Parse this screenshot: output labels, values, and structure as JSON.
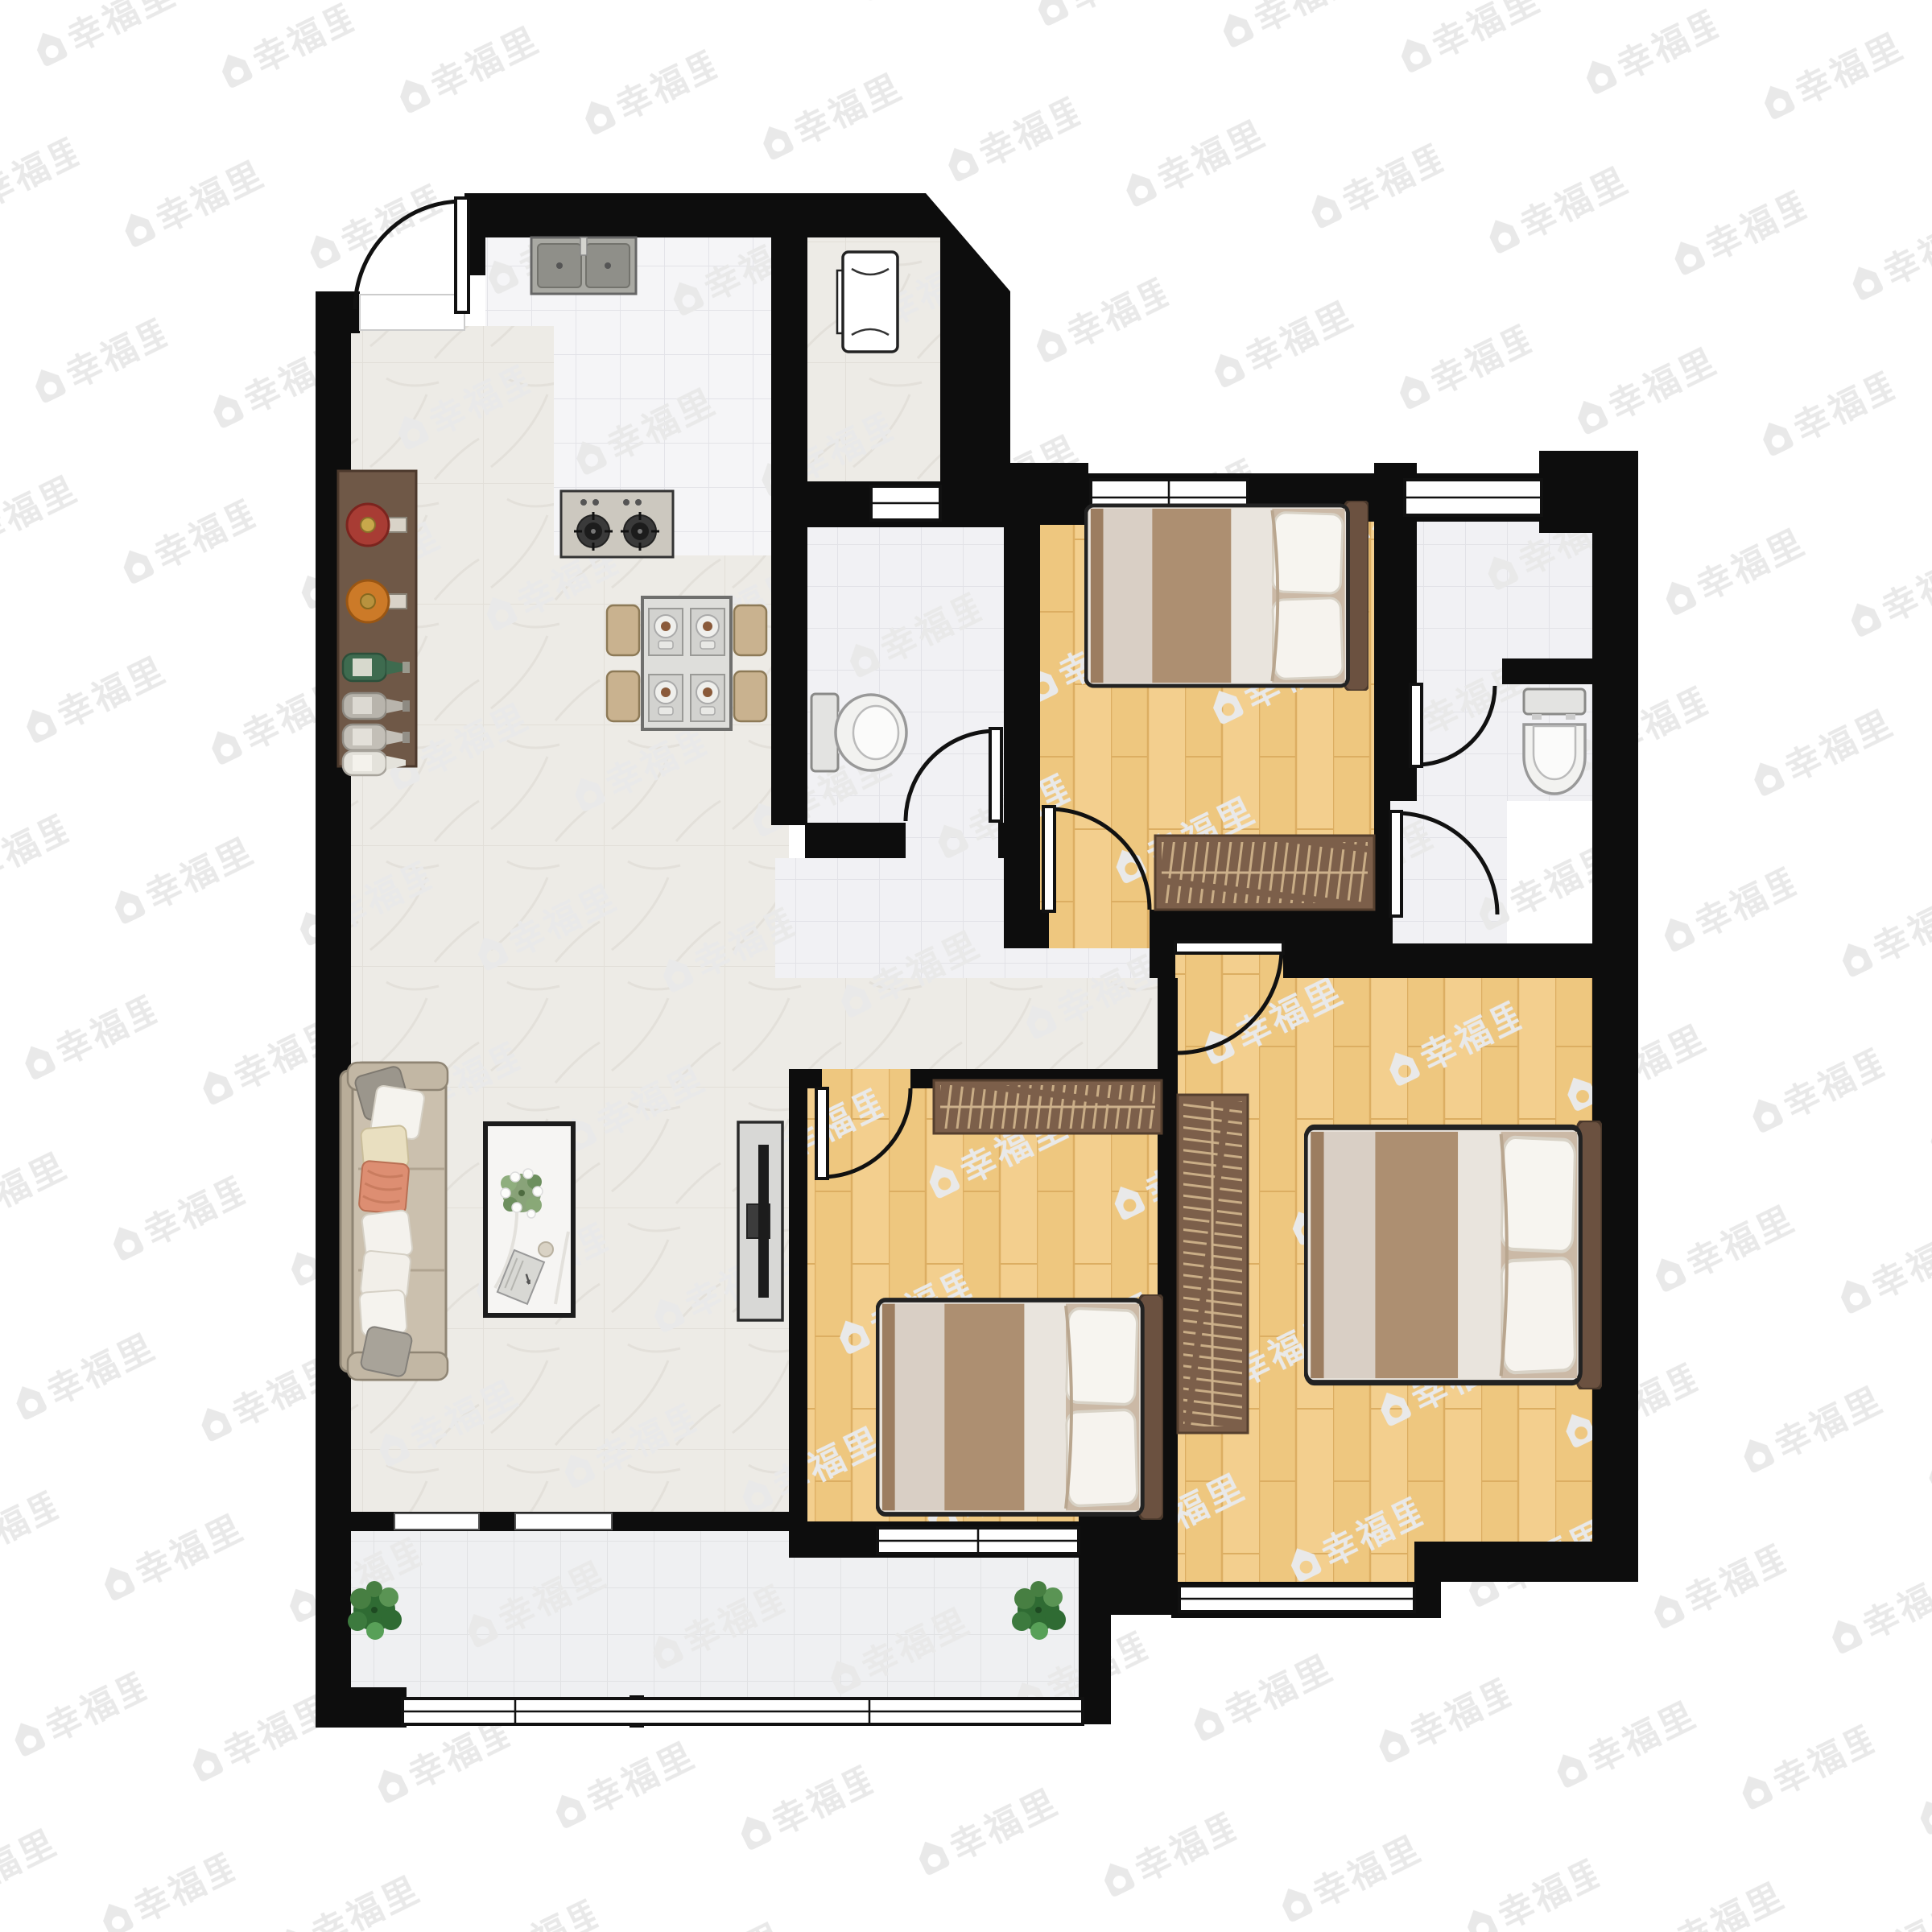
{
  "meta": {
    "type": "real-estate floor plan",
    "description": "Top-down furnished rendering of a 3-bedroom, 2-bathroom apartment with kitchen, dining and living area, and a bottom balcony. No dimension labels or room-name text are printed on the plan; the only text is the repeated watermark."
  },
  "watermark": {
    "text": "幸福里",
    "icon": "house-icon",
    "tile_color": "#e9e9e9"
  },
  "palette": {
    "wall": "#0d0d0d",
    "marble": "#edebe6",
    "tile": "#f5f5f7",
    "bath": "#f1f1f4",
    "balcony": "#eff0f2",
    "wood": "#f3cf8e",
    "wood_line": "#dcae62",
    "wardrobe": "#7c5f4a",
    "headboard": "#6b5140",
    "duvet_brown": "#ad8f71",
    "duvet_cream": "#d9cfc5",
    "sofa": "#cbc0ae",
    "plant_green": "#3f7a3f",
    "bottle_red": "#a83c34",
    "bottle_orange": "#cc7a28"
  },
  "rooms": [
    {
      "id": "entry",
      "name": "entry",
      "features": [
        "entrance-door"
      ]
    },
    {
      "id": "kitchen",
      "name": "kitchen",
      "features": [
        "double-sink",
        "gas-stove-2-burner"
      ]
    },
    {
      "id": "utility-nook",
      "name": "utility nook",
      "features": [
        "washing-machine",
        "angled-corner-wall",
        "interior-window"
      ]
    },
    {
      "id": "dining",
      "name": "dining area",
      "features": [
        "table-4-place-settings",
        "4-chairs",
        "wine-cabinet-6-bottles"
      ]
    },
    {
      "id": "living",
      "name": "living room",
      "features": [
        "sofa-8-pillows",
        "coffee-table-flowers-book",
        "tv-stand"
      ]
    },
    {
      "id": "bathroom-1",
      "name": "bathroom 1",
      "features": [
        "toilet",
        "door"
      ]
    },
    {
      "id": "bedroom-2",
      "name": "bedroom top-right",
      "features": [
        "double-bed",
        "wardrobe",
        "window",
        "door"
      ]
    },
    {
      "id": "bathroom-2",
      "name": "bathroom 2",
      "features": [
        "toilet",
        "inner-door",
        "lobby-door",
        "window"
      ]
    },
    {
      "id": "bedroom-3",
      "name": "bedroom bottom-middle",
      "features": [
        "double-bed",
        "wardrobe",
        "window",
        "door"
      ]
    },
    {
      "id": "master-bedroom",
      "name": "master bedroom",
      "features": [
        "double-bed",
        "wardrobe",
        "window",
        "door"
      ]
    },
    {
      "id": "balcony",
      "name": "balcony",
      "features": [
        "plant",
        "plant",
        "full-width-window",
        "sliding-thresholds"
      ]
    }
  ]
}
